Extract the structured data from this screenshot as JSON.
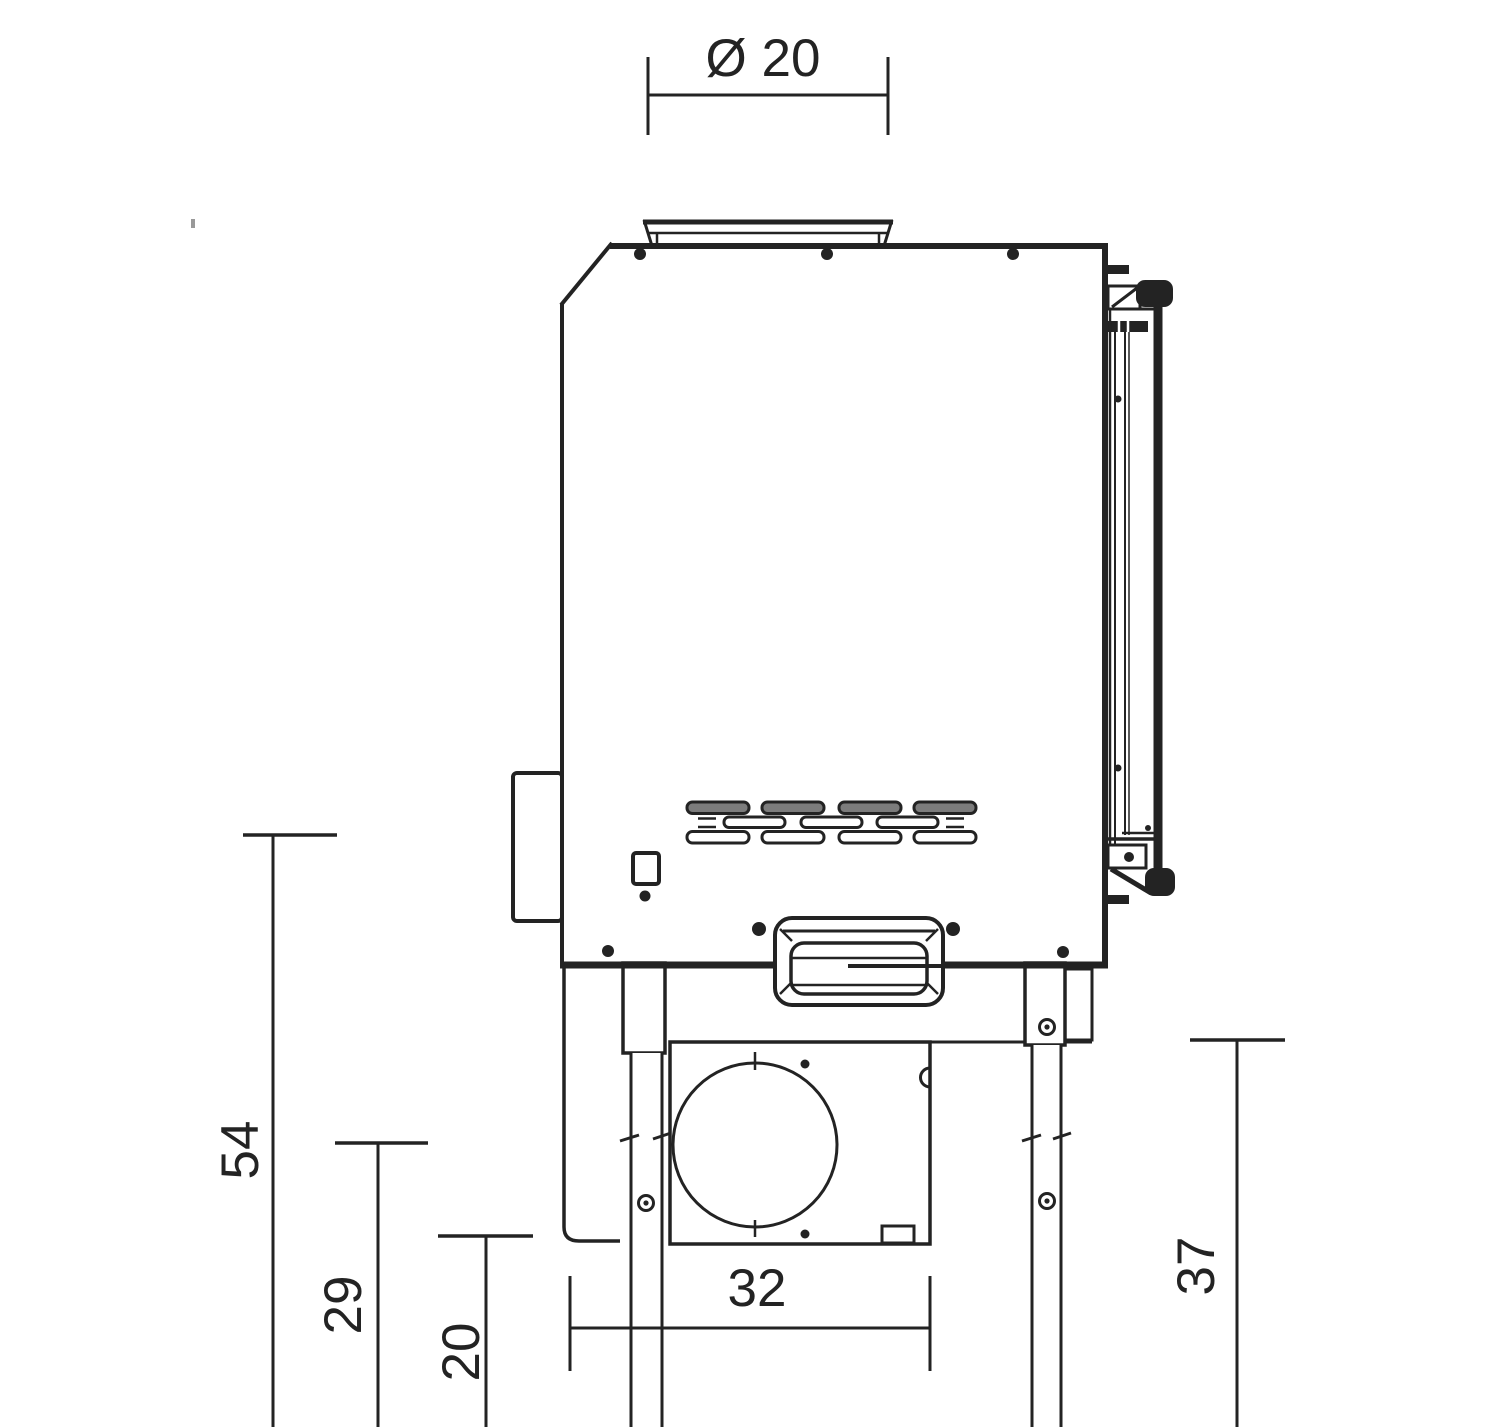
{
  "drawing_kind": "technical side-view dimension drawing of a fireplace insert stove",
  "dimensions": {
    "flue_diameter": "Ø 20",
    "overall_height": "54",
    "hearth_height": "29",
    "pedestal_height": "20",
    "base_depth": "32",
    "rear_leg_height": "37"
  },
  "colors": {
    "line": "#232323",
    "vent_fill": "#7c7c7c",
    "background": "#ffffff"
  }
}
